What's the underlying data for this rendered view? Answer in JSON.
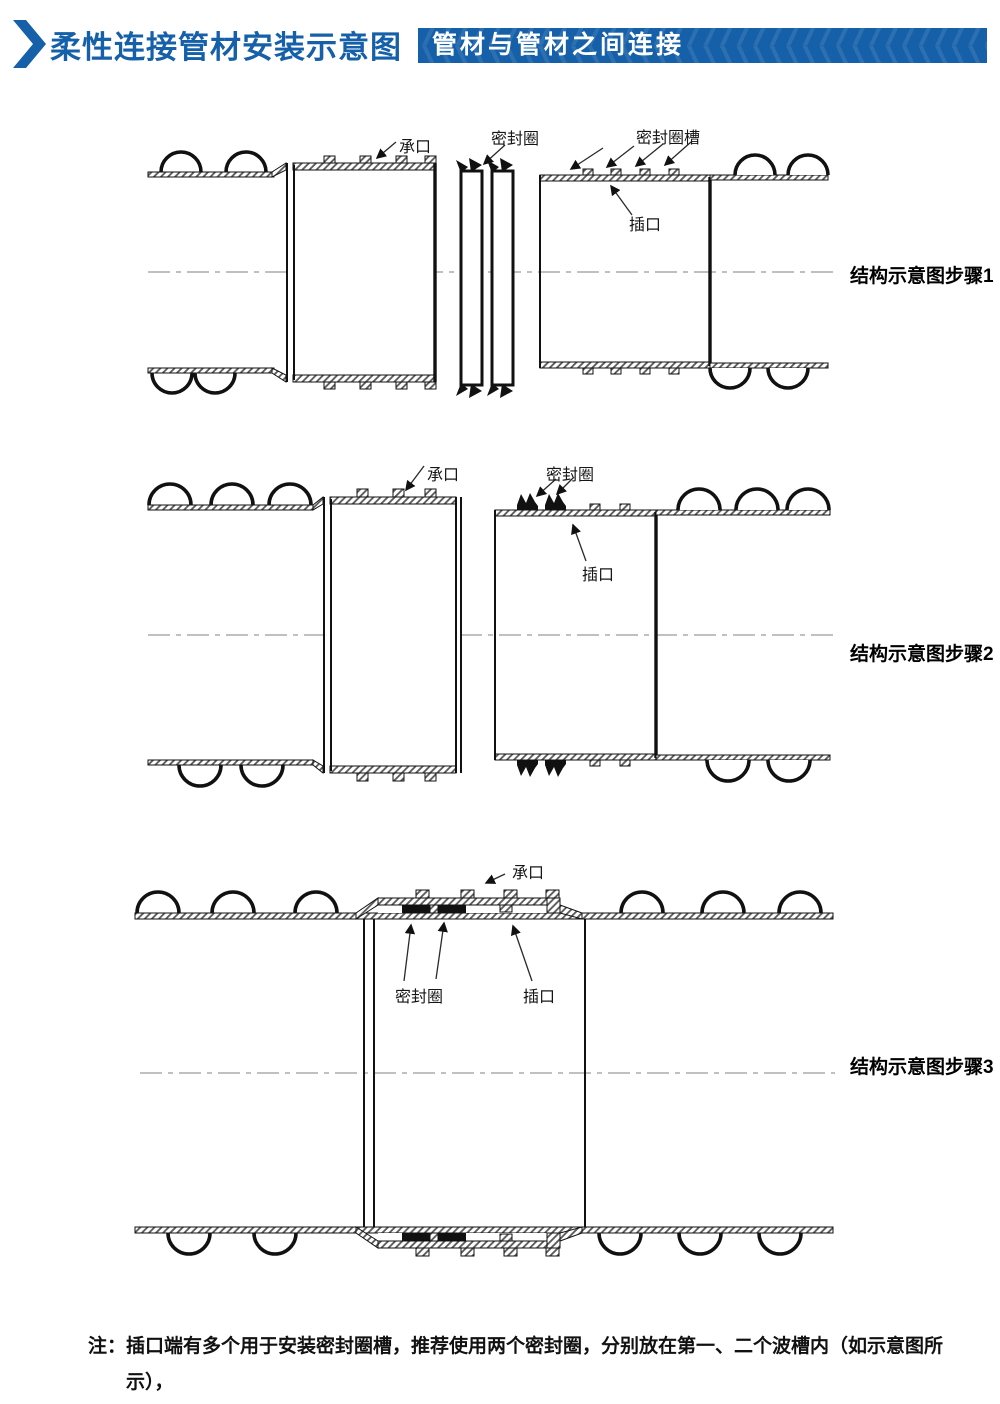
{
  "header": {
    "title": "柔性连接管材安装示意图",
    "banner_text": "管材与管材之间连接",
    "accent_color": "#1560a8",
    "chevron_icon": "double-chevron-right"
  },
  "diagrams": [
    {
      "caption": "结构示意图步骤1",
      "labels": {
        "socket": "承口",
        "seal_ring": "密封圈",
        "seal_ring_groove": "密封圈槽",
        "spigot": "插口"
      }
    },
    {
      "caption": "结构示意图步骤2",
      "labels": {
        "socket": "承口",
        "seal_ring": "密封圈",
        "spigot": "插口"
      }
    },
    {
      "caption": "结构示意图步骤3",
      "labels": {
        "socket": "承口",
        "seal_ring": "密封圈",
        "spigot": "插口"
      }
    }
  ],
  "note": {
    "prefix": "注：",
    "line1": "插口端有多个用于安装密封圈槽，推荐使用两个密封圈，分别放在第一、二个波槽内（如示意图所示），",
    "line2": "也可根据安装情况，适当的调整放置位置和数量。"
  }
}
